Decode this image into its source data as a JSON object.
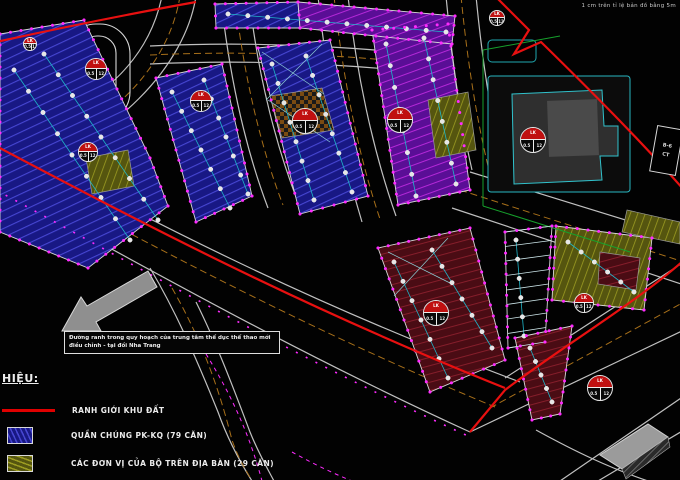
{
  "scale_note": "1 cm trên tỉ lệ bản đồ bằng 5m",
  "annotation": {
    "line1": "Đường ranh trong quy hoạch của trung tâm thể dục thể thao mới",
    "line2": "điều chỉnh - tại đồi Nha Trang"
  },
  "edge_label": {
    "line1": "B-6",
    "line2": "CT"
  },
  "legend": {
    "heading": "HIỆU:",
    "items": [
      {
        "style": "line",
        "label": "RANH GIỚI KHU ĐẤT"
      },
      {
        "style": "blue",
        "label": "QUẦN CHÚNG PK-KQ (79 CĂN)"
      },
      {
        "style": "olive",
        "label": "CÁC ĐƠN VỊ CỦA BỘ TRÊN ĐỊA BÀN (29 CĂN)"
      }
    ]
  },
  "badge": {
    "code": "LK",
    "left": "0.5",
    "right": "12"
  },
  "colors": {
    "boundary": "#e81010",
    "magenta": "#ff2bff",
    "blue_fill": "#181884",
    "purple_fill": "#5a0e96",
    "olive_fill": "#55550f",
    "maroon_fill": "#4a0c14",
    "road_edge": "#c0c0c0",
    "centerline": "#a8701a",
    "cyan": "#1fb6c9",
    "green": "#16a02c"
  }
}
